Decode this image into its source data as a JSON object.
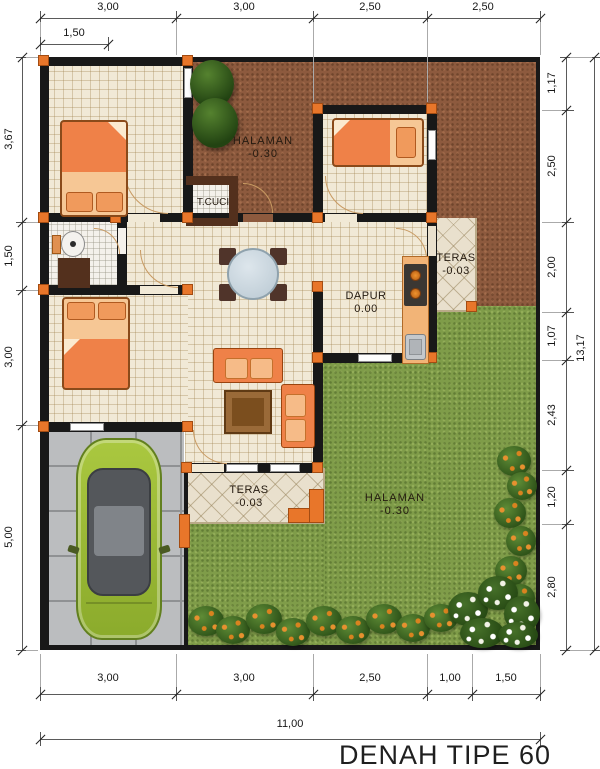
{
  "title": "DENAH TIPE 60",
  "dims": {
    "top_row": [
      "3,00",
      "3,00",
      "2,50",
      "2,50"
    ],
    "top_sub": "1,50",
    "left": [
      "3,67",
      "1,50",
      "3,00",
      "5,00"
    ],
    "right": [
      "1,17",
      "2,50",
      "2,00",
      "1,07",
      "2,43",
      "1,20",
      "2,80"
    ],
    "right_total": "13,17",
    "bottom": [
      "3,00",
      "3,00",
      "2,50",
      "1,00",
      "1,50"
    ],
    "bottom_total": "11,00"
  },
  "rooms": {
    "halaman_back": {
      "name": "HALAMAN",
      "level": "-0.30"
    },
    "tcuci": {
      "name": "T.CUCI"
    },
    "teras_back": {
      "name": "TERAS",
      "level": "-0.03"
    },
    "dapur": {
      "name": "DAPUR",
      "level": "0.00"
    },
    "teras_front": {
      "name": "TERAS",
      "level": "-0.03"
    },
    "halaman_front": {
      "name": "HALAMAN",
      "level": "-0.30"
    }
  },
  "colors": {
    "wall": "#181818",
    "column_post": "#e8762a",
    "soil": "#8d5a3e",
    "grass": "#7f9c49",
    "floor_tile": "#f1e9d6",
    "carport": "#bbbdbf",
    "furniture": "#ef8148",
    "car_body": "#a0be38"
  }
}
